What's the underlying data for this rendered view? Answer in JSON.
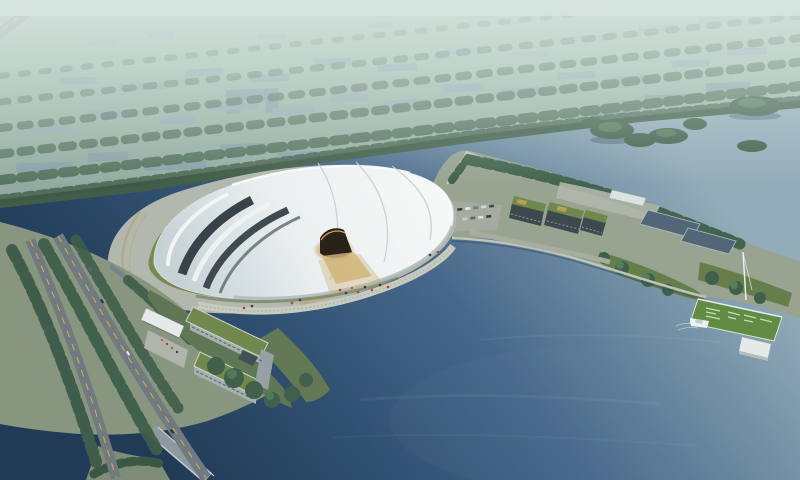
{
  "scene": {
    "type": "architectural-aerial-rendering",
    "subject": "white shell-roofed lakeside hall at dusk",
    "elements": [
      "hazy-city-district",
      "tree-belt",
      "river-with-islands",
      "deep-blue-lake",
      "main-exhibition-hall",
      "glowing-entrance",
      "lawn-apron",
      "waterfront-steps",
      "parking-lot",
      "eco-buildings",
      "reflecting-pools",
      "shore-promenade",
      "boulevard-roads",
      "channel-bridge",
      "l-shaped-building",
      "entrance-canopy",
      "garden-pier",
      "pier-pavilion",
      "moored-boat"
    ]
  },
  "colors": {
    "haze": "#dce8e4",
    "city_land_top": "#a9c2b4",
    "city_land_bottom": "#8fa69d",
    "building_block": "#8b9fa8",
    "building_block_light": "#97aab2",
    "building_block_far": "#a2b3ba",
    "tree_dark": "#3a5845",
    "tree_mid": "#4c6a55",
    "tree_top": "#547a57",
    "river": "#93abba",
    "lake_mid": "#44648a",
    "lake_deep": "#1b3452",
    "plaza": "#b5b8ae",
    "lawn": "#78874a",
    "roof_white": "#f6f8f8",
    "roof_shadow": "#c9d2d6",
    "glass_dark": "#323d44",
    "glass_dark2": "#3a454c",
    "glow": "#e09a42",
    "road": "#6e767e",
    "road_line": "#d2b13e",
    "parcel": "#98a28f",
    "parcel_green": "#87947d",
    "green_roof": "#6d8549",
    "dark_building": "#39434a",
    "pool": "#4e6175",
    "pier_lawn": "#5f8a3e",
    "white_struct": "#e9eded",
    "embankment": "#b3a98c",
    "steps": "#c9cbc0",
    "people_red": "#b03a2e",
    "people_orange": "#c05a28"
  }
}
